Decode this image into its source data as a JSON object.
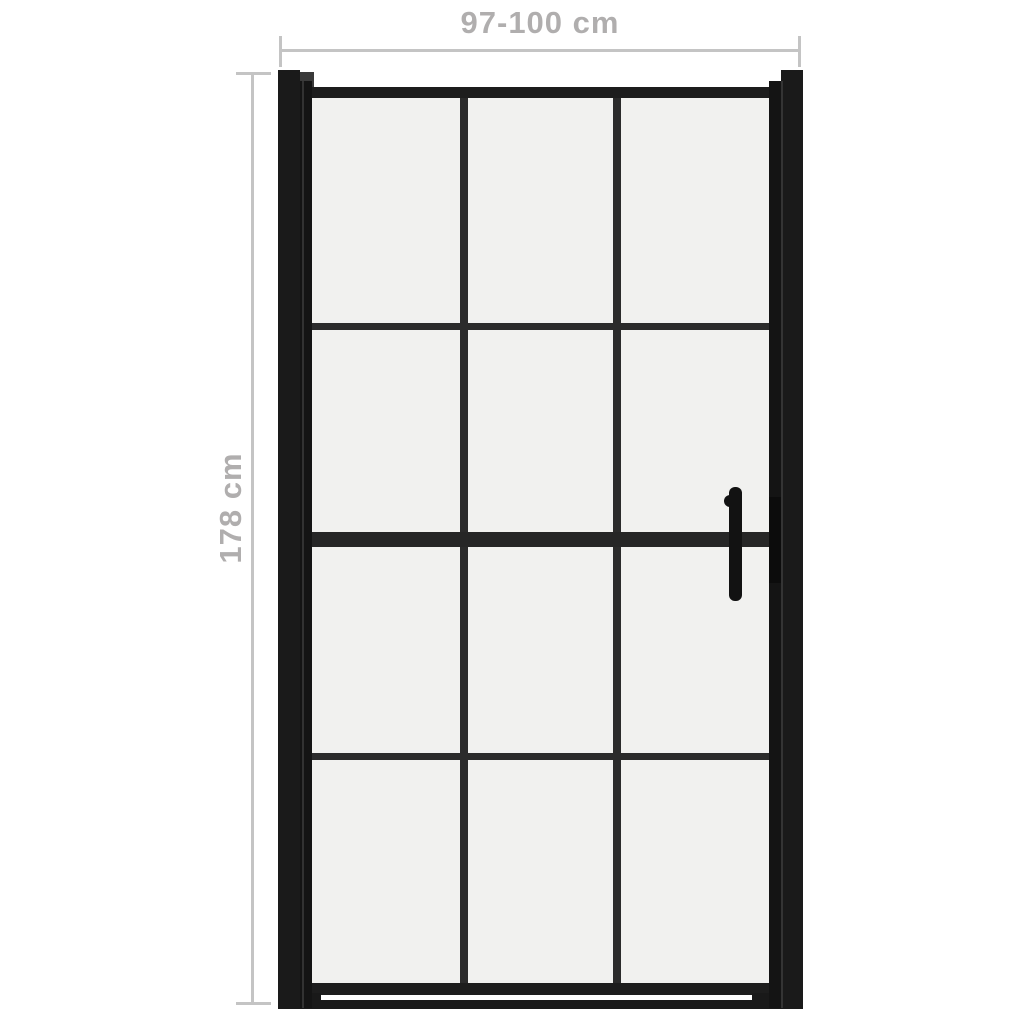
{
  "page": {
    "type": "product dimension diagram",
    "background": "#ffffff"
  },
  "product": {
    "name": "framed glass shower door",
    "description": "black framed shower door, 3 columns x 4 rows glass pane grid, vertical bar handle on right side"
  },
  "dimensions": {
    "width_label": "97-100 cm",
    "height_label": "178 cm"
  },
  "grid": {
    "columns": 3,
    "rows": 4
  },
  "colors": {
    "frame": "#1a1a1a",
    "stile": "#141414",
    "rail": "#1d1d1d",
    "grid_line": "#2b2b2b",
    "glass": "#f1f1ef",
    "dimension_line": "#c4c4c4",
    "dimension_text": "#b0aeae",
    "hinge_cap": "#3a3a3a",
    "background": "#ffffff"
  }
}
